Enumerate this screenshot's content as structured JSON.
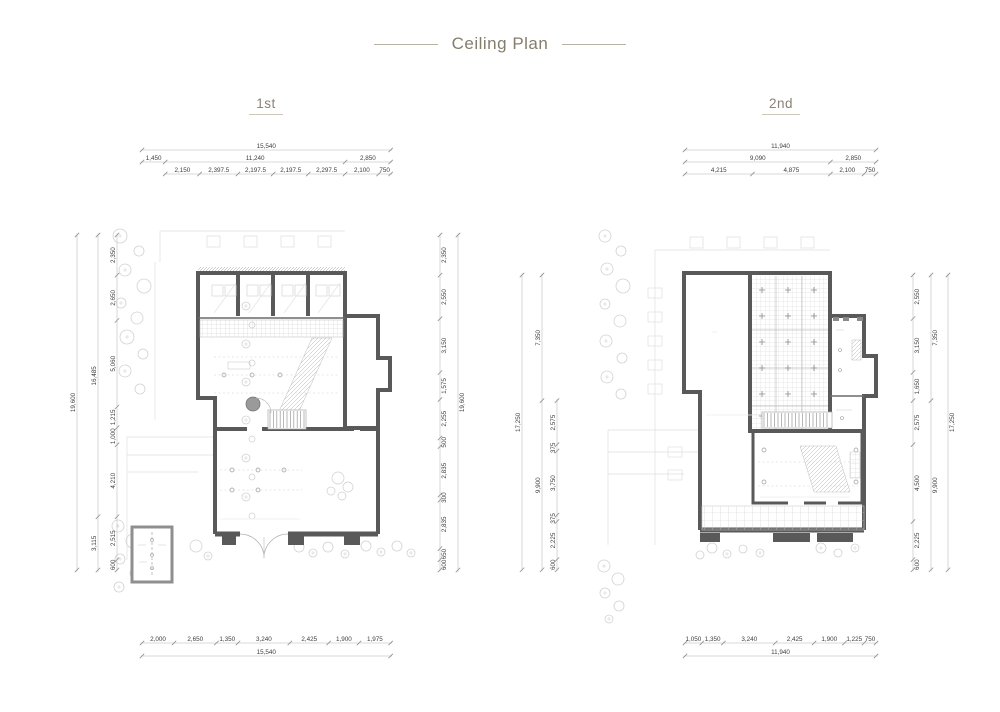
{
  "title": "Ceiling Plan",
  "plans": [
    {
      "label": "1st",
      "dims": {
        "top_rows": [
          {
            "offset": 0,
            "segments": [
              15540
            ]
          },
          {
            "offset": 0,
            "segments": [
              1450,
              11240,
              2850
            ]
          },
          {
            "offset": 1450,
            "segments": [
              2150,
              2397.5,
              2197.5,
              2197.5,
              2297.5,
              2100,
              750
            ]
          }
        ],
        "bottom_rows": [
          {
            "offset": 0,
            "segments": [
              2000,
              2650,
              1350,
              3240,
              2425,
              1900,
              1975
            ]
          },
          {
            "offset": 0,
            "segments": [
              15540
            ]
          }
        ],
        "left_cols": [
          {
            "offset": 0,
            "segments": [
              19600
            ]
          },
          {
            "offset": 0,
            "segments": [
              16485,
              3115
            ]
          },
          {
            "offset": 0,
            "segments": [
              2350,
              2650,
              5060,
              1215,
              1000,
              4210,
              2515,
              600
            ]
          }
        ],
        "right_cols": [
          {
            "offset": 0,
            "segments": [
              2350,
              2550,
              3150,
              1575,
              2255,
              500,
              2835,
              300,
              2835,
              650,
              600
            ]
          },
          {
            "offset": 0,
            "segments": [
              19600
            ]
          }
        ],
        "width_total": 15540,
        "height_total": 19600
      }
    },
    {
      "label": "2nd",
      "dims": {
        "top_rows": [
          {
            "offset": 0,
            "segments": [
              11940
            ]
          },
          {
            "offset": 0,
            "segments": [
              9090,
              2850
            ]
          },
          {
            "offset": 0,
            "segments": [
              4215,
              4875,
              2100,
              750
            ]
          }
        ],
        "bottom_rows": [
          {
            "offset": 0,
            "segments": [
              1050,
              1350,
              3240,
              2425,
              1900,
              1225,
              750
            ]
          },
          {
            "offset": 0,
            "segments": [
              11940
            ]
          }
        ],
        "left_cols": [
          {
            "offset": 0,
            "segments": [
              17250
            ]
          },
          {
            "offset": 0,
            "segments": [
              7350,
              9900
            ]
          },
          {
            "offset": 7350,
            "segments": [
              2575,
              375,
              3750,
              375,
              2225,
              600
            ]
          }
        ],
        "right_cols": [
          {
            "offset": 0,
            "segments": [
              2550,
              3150,
              1650,
              2575,
              4500,
              2225,
              600
            ]
          },
          {
            "offset": 0,
            "segments": [
              7350,
              9900
            ]
          },
          {
            "offset": 0,
            "segments": [
              17250
            ]
          }
        ],
        "width_total": 11940,
        "height_total": 17250
      }
    }
  ]
}
